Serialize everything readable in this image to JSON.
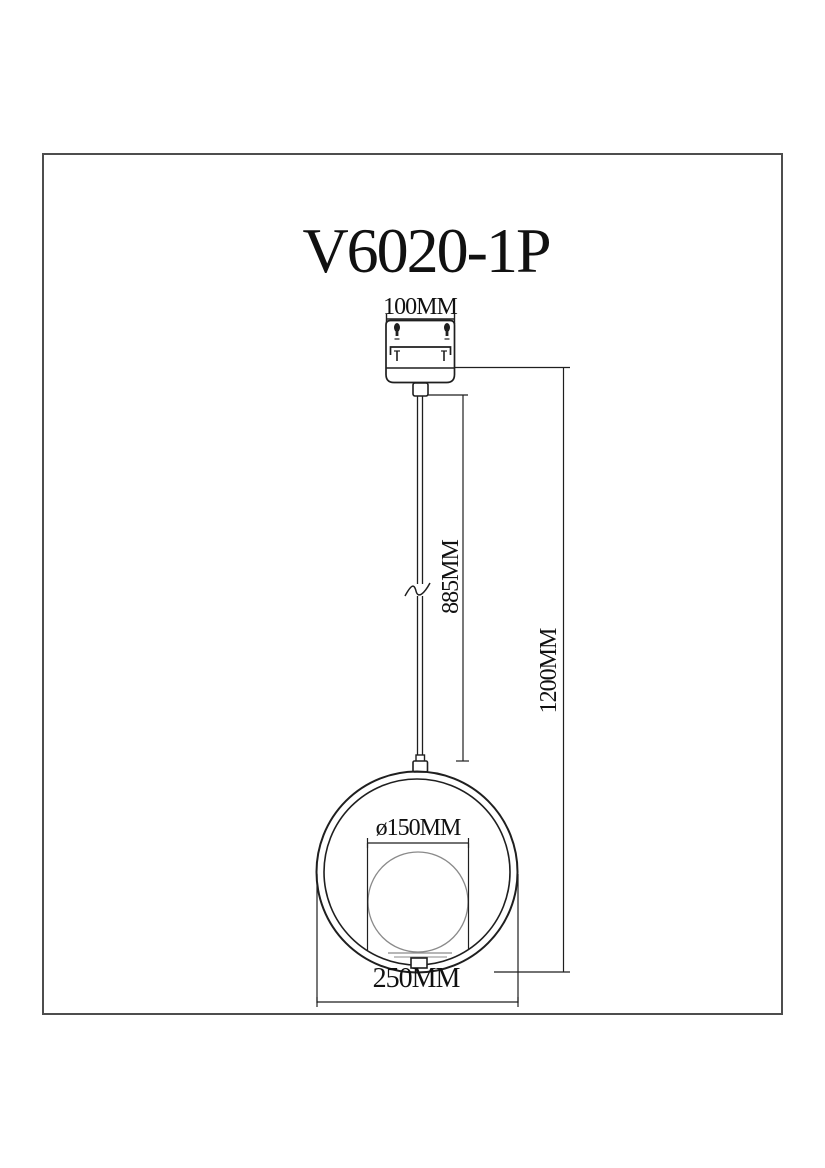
{
  "title": "V6020-1P",
  "drawing": {
    "canopy_width_label": "100MM",
    "cord_length_label": "885MM",
    "overall_height_label": "1200MM",
    "globe_diameter_label": "ø150MM",
    "ring_diameter_label": "250MM"
  },
  "colors": {
    "background": "#ffffff",
    "frame": "#4d4d4d",
    "line": "#1f1f1f",
    "sphere_line": "#8a8a8a",
    "text": "#111111"
  }
}
